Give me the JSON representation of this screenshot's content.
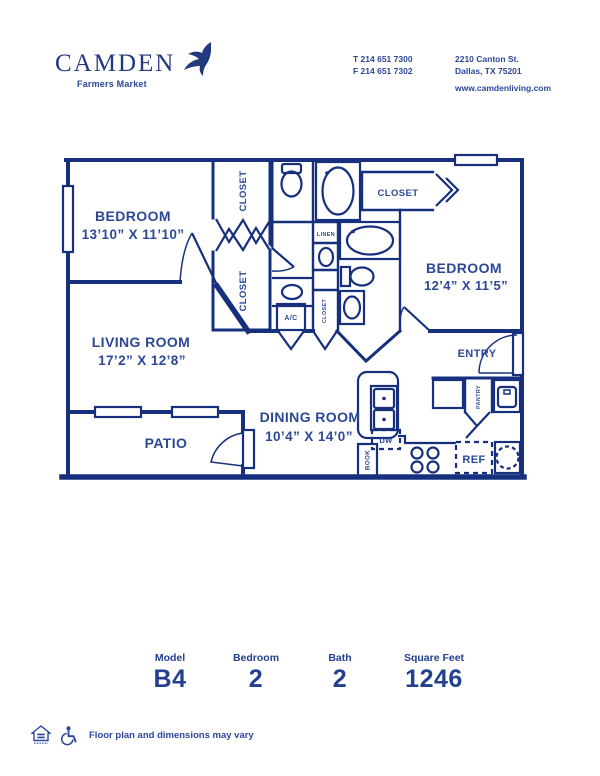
{
  "brand": {
    "name": "CAMDEN",
    "community": "Farmers Market"
  },
  "contact": {
    "phone_line1": "T 214 651 7300",
    "phone_line2": "F 214 651 7302",
    "address_line1": "2210 Canton St.",
    "address_line2": "Dallas, TX 75201",
    "website": "www.camdenliving.com"
  },
  "floorplan": {
    "rooms": {
      "bedroom1": {
        "name": "BEDROOM",
        "dims": "13’10” X 11’10”"
      },
      "bedroom2": {
        "name": "BEDROOM",
        "dims": "12’4” X 11’5”"
      },
      "living": {
        "name": "LIVING ROOM",
        "dims": "17’2” X 12’8”"
      },
      "dining": {
        "name": "DINING ROOM",
        "dims": "10’4” X 14’0”"
      },
      "patio": {
        "name": "PATIO"
      },
      "entry": {
        "name": "ENTRY"
      }
    },
    "labels": {
      "closet_a": "CLOSET",
      "closet_b": "CLOSET",
      "closet_c": "CLOSET",
      "closet_bedroom2": "CLOSET",
      "linen": "LINEN",
      "ac": "A/C",
      "pantry": "PANTRY",
      "book": "BOOK",
      "dw": "DW",
      "ref": "REF"
    }
  },
  "stats": {
    "items": [
      {
        "label": "Model",
        "value": "B4"
      },
      {
        "label": "Bedroom",
        "value": "2"
      },
      {
        "label": "Bath",
        "value": "2"
      },
      {
        "label": "Square Feet",
        "value": "1246"
      }
    ]
  },
  "footer": {
    "disclaimer": "Floor plan and dimensions may vary"
  },
  "colors": {
    "navy": "#2b479b",
    "wall": "#16307e"
  }
}
